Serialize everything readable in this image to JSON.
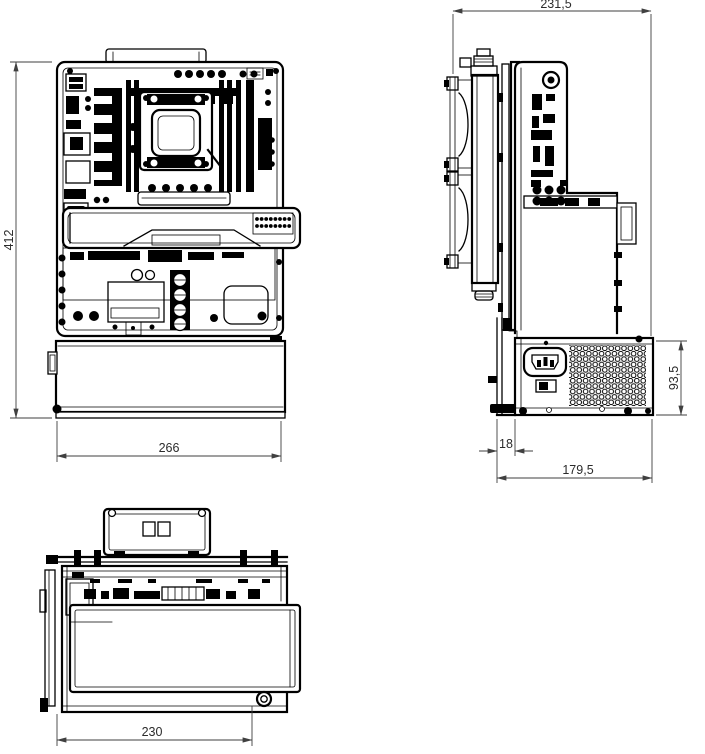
{
  "drawing": {
    "dimensions": {
      "front_height": "412",
      "front_width": "266",
      "side_overall_width": "231,5",
      "psu_height": "93,5",
      "psu_offset": "18",
      "side_base_depth": "179,5",
      "top_depth": "230"
    },
    "colors": {
      "line": "#000000",
      "dimension": "#3f3f3f",
      "background": "#ffffff"
    }
  }
}
